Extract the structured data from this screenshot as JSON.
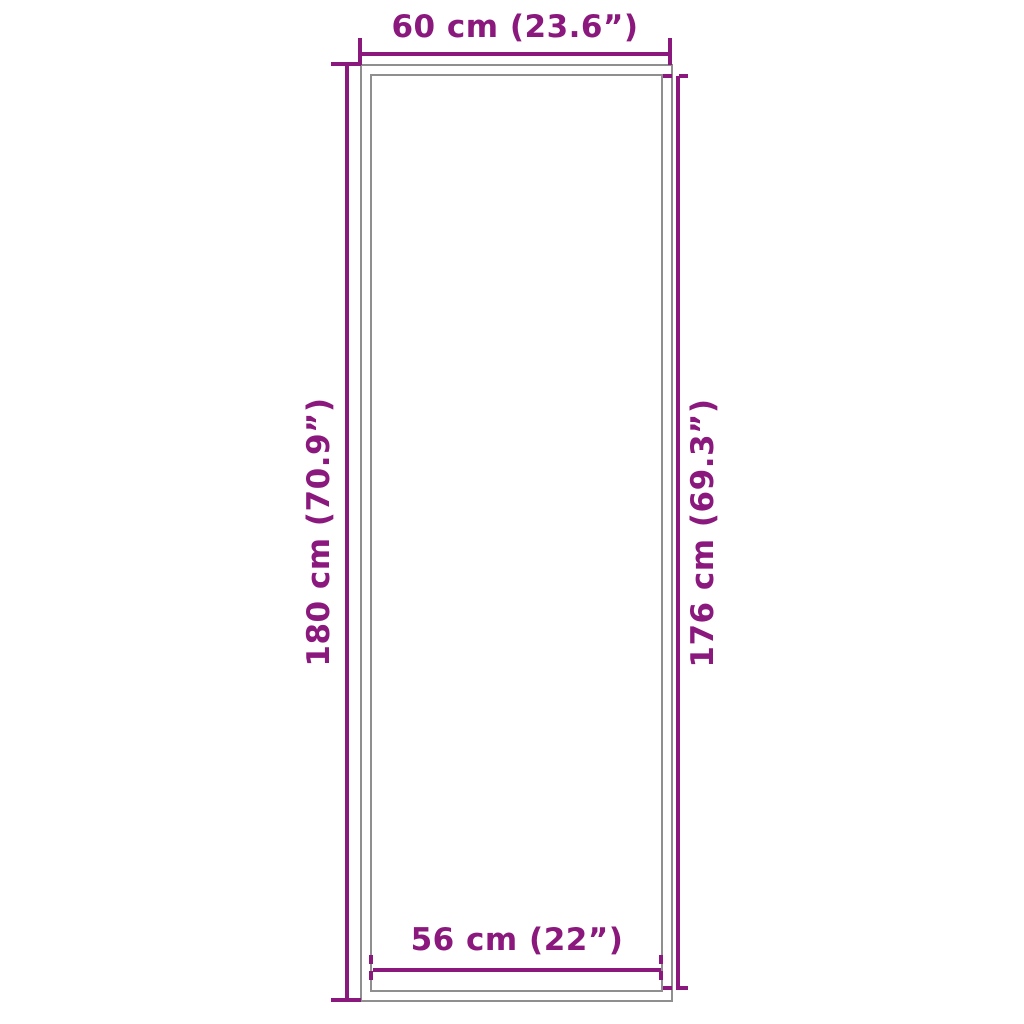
{
  "figure": {
    "type": "product-dimension-diagram",
    "dimensions": {
      "outer_width": {
        "label": "60 cm (23.6”)",
        "cm": 60,
        "inches": 23.6
      },
      "outer_height": {
        "label": "180 cm (70.9”)",
        "cm": 180,
        "inches": 70.9
      },
      "inner_height": {
        "label": "176 cm (69.3”)",
        "cm": 176,
        "inches": 69.3
      },
      "inner_width": {
        "label": "56 cm (22”)",
        "cm": 56,
        "inches": 22
      }
    }
  },
  "colors": {
    "dimension": "#8a187d",
    "outline": "#8f8f8f",
    "background": "#ffffff"
  }
}
